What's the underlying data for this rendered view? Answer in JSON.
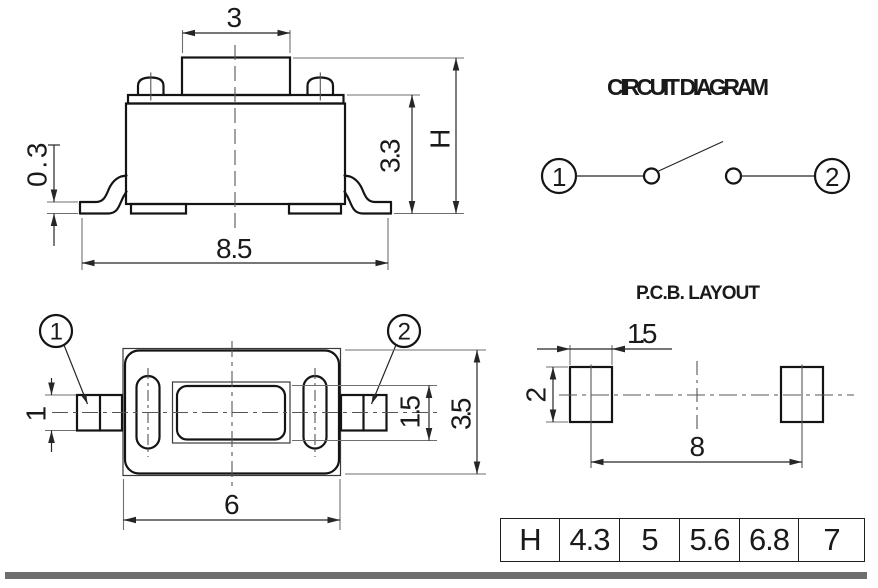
{
  "side_view": {
    "dim_top_width": "3",
    "dim_standoff": "0.3",
    "dim_base_width": "8.5",
    "dim_body_height": "3.3",
    "dim_total_height": "H"
  },
  "circuit_diagram": {
    "title": "CIRCUIT DIAGRAM",
    "terminal_1": "1",
    "terminal_2": "2"
  },
  "top_view": {
    "terminal_1_label": "1",
    "terminal_2_label": "2",
    "dim_terminal_width": "1",
    "dim_actuator_depth": "1.5",
    "dim_body_depth": "3.5",
    "dim_body_width": "6"
  },
  "pcb_layout": {
    "title": "P.C.B. LAYOUT",
    "dim_pad_width": "1.5",
    "dim_pad_height": "2",
    "dim_pad_pitch": "8"
  },
  "dim_table": {
    "header": "H",
    "values": [
      "4.3",
      "5",
      "5.6",
      "6.8",
      "7"
    ]
  },
  "colors": {
    "outline": "#141414",
    "dimension_lines": "#262626",
    "extension_lines": "#6f6f6f",
    "footer_bar": "#6e6e6e",
    "background": "#ffffff"
  }
}
